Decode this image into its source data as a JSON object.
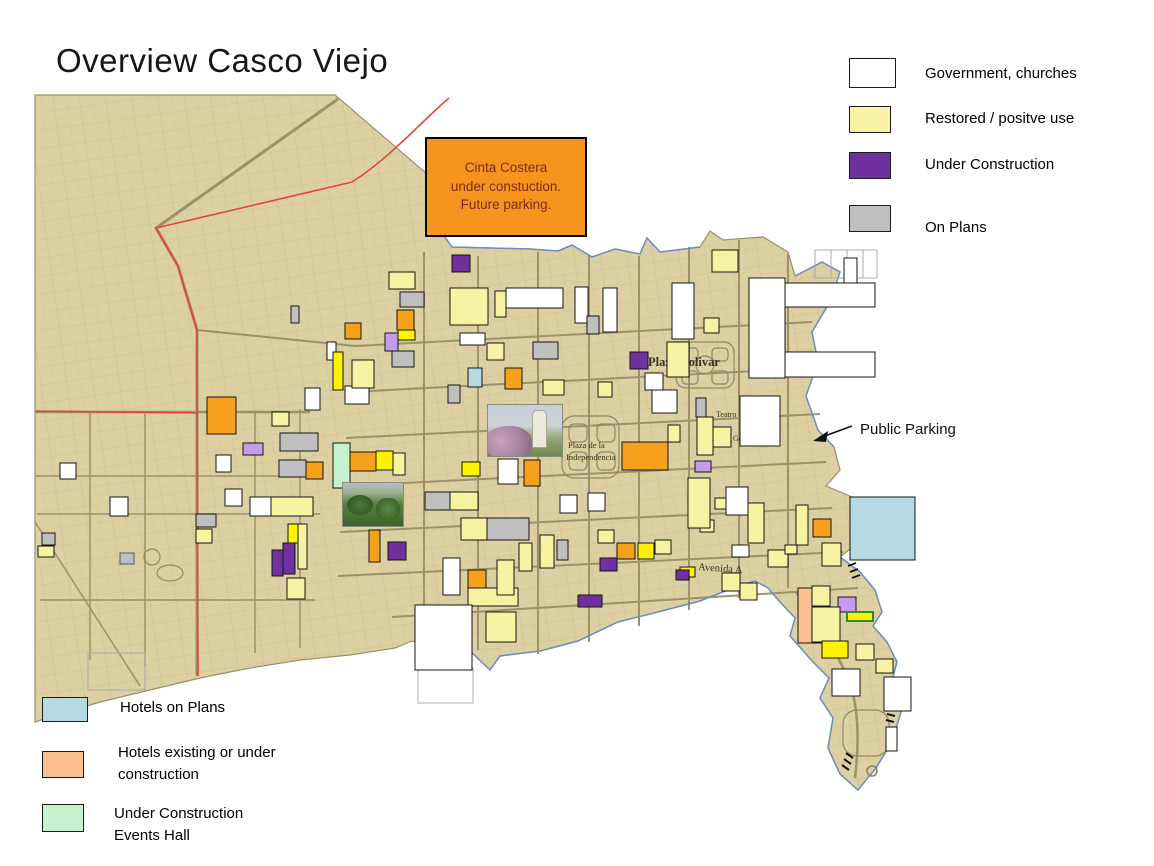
{
  "title": "Overview Casco Viejo",
  "callout": {
    "lines": [
      "Cinta Costera",
      "under constuction.",
      "Future parking."
    ],
    "fill": "#F7941E",
    "text_color": "#7B2A1E"
  },
  "legend_categories": {
    "items": [
      {
        "label": "Government, churches",
        "color": "#FFFFFF"
      },
      {
        "label": "Restored / positve use",
        "color": "#F7F3A2"
      },
      {
        "label": "Under Construction",
        "color": "#7030A0"
      },
      {
        "label": "On Plans",
        "color": "#BFBFBF"
      }
    ]
  },
  "legend_hotels": {
    "items": [
      {
        "label": "Hotels on Plans",
        "color": "#B5DAE3",
        "lines": [
          "Hotels on Plans",
          ""
        ]
      },
      {
        "label": "Hotels existing or under construction",
        "color": "#FAC091",
        "lines": [
          "Hotels existing or under",
          "construction"
        ]
      },
      {
        "label": "Under Construction Events Hall",
        "color": "#C6F2CF",
        "lines": [
          "Under Construction",
          "Events Hall"
        ]
      }
    ]
  },
  "annotations": {
    "public_parking": "Public Parking"
  },
  "map": {
    "land_color": "#DDD1A3",
    "land_edge_color": "#97906B",
    "street_color": "#9C9168",
    "route_color": "#E2443B",
    "coast_color": "#6C8EBF",
    "label_color": "#3A3222",
    "palette": {
      "W": "#FFFFFF",
      "Y": "#F7F3A2",
      "BY": "#FFF200",
      "O": "#F5A11B",
      "P": "#7030A0",
      "LP": "#C79BEB",
      "G": "#BFBFBF",
      "LB": "#B5DAE3",
      "MG": "#C6F2CF",
      "PC": "#FAC091"
    },
    "labels": [
      {
        "text": "Plaza Bolivar",
        "x": 648,
        "y": 366,
        "size": 12.5,
        "weight": "bold",
        "rotate": 0
      },
      {
        "text": "Teatro",
        "x": 716,
        "y": 417,
        "size": 8,
        "weight": "normal",
        "rotate": 0
      },
      {
        "text": "Gobierno",
        "x": 733,
        "y": 441,
        "size": 8,
        "weight": "normal",
        "rotate": 0
      },
      {
        "text": "Plaza de la",
        "x": 568,
        "y": 448,
        "size": 8.5,
        "weight": "normal",
        "rotate": 0
      },
      {
        "text": "Independencia",
        "x": 566,
        "y": 460,
        "size": 8.5,
        "weight": "normal",
        "rotate": 0
      },
      {
        "text": "Avenida A",
        "x": 698,
        "y": 570,
        "size": 10.5,
        "weight": "normal",
        "rotate": 4
      }
    ],
    "buildings": [
      [
        452,
        255,
        18,
        17,
        "P"
      ],
      [
        389,
        272,
        26,
        17,
        "Y"
      ],
      [
        400,
        292,
        24,
        15,
        "G"
      ],
      [
        397,
        310,
        17,
        20,
        "O"
      ],
      [
        398,
        330,
        17,
        10,
        "BY"
      ],
      [
        385,
        333,
        13,
        18,
        "LP"
      ],
      [
        392,
        351,
        22,
        16,
        "G"
      ],
      [
        450,
        288,
        38,
        37,
        "Y"
      ],
      [
        495,
        291,
        11,
        26,
        "Y"
      ],
      [
        506,
        288,
        57,
        20,
        "W"
      ],
      [
        575,
        287,
        13,
        36,
        "W"
      ],
      [
        587,
        316,
        12,
        18,
        "G"
      ],
      [
        603,
        288,
        14,
        44,
        "W"
      ],
      [
        672,
        283,
        22,
        56,
        "W"
      ],
      [
        712,
        250,
        26,
        22,
        "Y"
      ],
      [
        704,
        318,
        15,
        15,
        "Y"
      ],
      [
        749,
        278,
        36,
        100,
        "W"
      ],
      [
        785,
        283,
        90,
        24,
        "W"
      ],
      [
        785,
        352,
        90,
        25,
        "W"
      ],
      [
        844,
        258,
        13,
        25,
        "W"
      ],
      [
        460,
        333,
        25,
        12,
        "W"
      ],
      [
        487,
        343,
        17,
        17,
        "Y"
      ],
      [
        533,
        342,
        25,
        17,
        "G"
      ],
      [
        468,
        368,
        14,
        19,
        "LB"
      ],
      [
        505,
        368,
        17,
        21,
        "O"
      ],
      [
        448,
        385,
        12,
        18,
        "G"
      ],
      [
        543,
        380,
        21,
        15,
        "Y"
      ],
      [
        598,
        382,
        14,
        15,
        "Y"
      ],
      [
        645,
        373,
        18,
        17,
        "W"
      ],
      [
        667,
        342,
        22,
        35,
        "Y"
      ],
      [
        630,
        352,
        18,
        17,
        "P"
      ],
      [
        652,
        390,
        25,
        23,
        "W"
      ],
      [
        740,
        396,
        40,
        50,
        "W"
      ],
      [
        696,
        398,
        10,
        19,
        "G"
      ],
      [
        697,
        417,
        16,
        38,
        "Y"
      ],
      [
        713,
        427,
        18,
        20,
        "Y"
      ],
      [
        622,
        442,
        46,
        28,
        "O"
      ],
      [
        668,
        425,
        12,
        17,
        "Y"
      ],
      [
        695,
        461,
        16,
        11,
        "LP"
      ],
      [
        560,
        495,
        17,
        18,
        "W"
      ],
      [
        588,
        493,
        17,
        18,
        "W"
      ],
      [
        498,
        459,
        20,
        25,
        "W"
      ],
      [
        524,
        460,
        16,
        26,
        "O"
      ],
      [
        207,
        397,
        29,
        37,
        "O"
      ],
      [
        272,
        412,
        17,
        14,
        "Y"
      ],
      [
        305,
        388,
        15,
        22,
        "W"
      ],
      [
        345,
        386,
        24,
        18,
        "W"
      ],
      [
        352,
        360,
        22,
        28,
        "Y"
      ],
      [
        345,
        323,
        16,
        16,
        "O"
      ],
      [
        291,
        306,
        8,
        17,
        "G"
      ],
      [
        327,
        342,
        9,
        18,
        "W"
      ],
      [
        333,
        352,
        10,
        38,
        "BY"
      ],
      [
        243,
        443,
        20,
        12,
        "LP"
      ],
      [
        280,
        433,
        38,
        18,
        "G"
      ],
      [
        279,
        460,
        27,
        17,
        "G"
      ],
      [
        306,
        462,
        17,
        17,
        "O"
      ],
      [
        333,
        443,
        17,
        45,
        "MG"
      ],
      [
        350,
        452,
        26,
        19,
        "O"
      ],
      [
        376,
        451,
        17,
        19,
        "BY"
      ],
      [
        393,
        453,
        12,
        22,
        "Y"
      ],
      [
        216,
        455,
        15,
        17,
        "W"
      ],
      [
        60,
        463,
        16,
        16,
        "W"
      ],
      [
        110,
        497,
        18,
        19,
        "W"
      ],
      [
        225,
        489,
        17,
        17,
        "W"
      ],
      [
        250,
        497,
        21,
        19,
        "W"
      ],
      [
        271,
        497,
        42,
        19,
        "Y"
      ],
      [
        196,
        514,
        20,
        13,
        "G"
      ],
      [
        196,
        529,
        16,
        14,
        "Y"
      ],
      [
        42,
        533,
        13,
        12,
        "G"
      ],
      [
        38,
        546,
        16,
        11,
        "Y"
      ],
      [
        272,
        550,
        11,
        26,
        "P"
      ],
      [
        283,
        543,
        12,
        31,
        "P"
      ],
      [
        287,
        578,
        18,
        21,
        "Y"
      ],
      [
        288,
        524,
        10,
        19,
        "BY"
      ],
      [
        298,
        524,
        9,
        45,
        "Y"
      ],
      [
        369,
        530,
        11,
        32,
        "O"
      ],
      [
        388,
        542,
        18,
        18,
        "P"
      ],
      [
        425,
        492,
        25,
        18,
        "G"
      ],
      [
        450,
        492,
        28,
        18,
        "Y"
      ],
      [
        462,
        462,
        18,
        14,
        "BY"
      ],
      [
        487,
        518,
        42,
        22,
        "G"
      ],
      [
        461,
        518,
        26,
        22,
        "Y"
      ],
      [
        443,
        558,
        17,
        37,
        "W"
      ],
      [
        468,
        570,
        18,
        18,
        "O"
      ],
      [
        468,
        588,
        50,
        18,
        "Y"
      ],
      [
        497,
        560,
        17,
        35,
        "Y"
      ],
      [
        415,
        605,
        57,
        65,
        "W"
      ],
      [
        486,
        612,
        30,
        30,
        "Y"
      ],
      [
        540,
        535,
        14,
        33,
        "Y"
      ],
      [
        519,
        543,
        13,
        28,
        "Y"
      ],
      [
        557,
        540,
        11,
        20,
        "G"
      ],
      [
        598,
        530,
        16,
        13,
        "Y"
      ],
      [
        600,
        558,
        17,
        13,
        "P"
      ],
      [
        578,
        595,
        24,
        12,
        "P"
      ],
      [
        617,
        543,
        18,
        16,
        "O"
      ],
      [
        638,
        543,
        16,
        16,
        "BY"
      ],
      [
        655,
        540,
        16,
        14,
        "Y"
      ],
      [
        680,
        567,
        15,
        10,
        "BY"
      ],
      [
        722,
        573,
        18,
        18,
        "Y"
      ],
      [
        740,
        583,
        17,
        17,
        "Y"
      ],
      [
        732,
        545,
        17,
        12,
        "W"
      ],
      [
        768,
        550,
        20,
        17,
        "Y"
      ],
      [
        785,
        545,
        12,
        9,
        "Y"
      ],
      [
        700,
        520,
        14,
        12,
        "Y"
      ],
      [
        715,
        498,
        13,
        11,
        "Y"
      ],
      [
        726,
        487,
        22,
        28,
        "W"
      ],
      [
        748,
        503,
        16,
        40,
        "Y"
      ],
      [
        688,
        478,
        22,
        50,
        "Y"
      ],
      [
        676,
        570,
        13,
        10,
        "P"
      ],
      [
        796,
        505,
        12,
        40,
        "Y"
      ],
      [
        813,
        519,
        18,
        18,
        "O"
      ],
      [
        822,
        543,
        19,
        23,
        "Y"
      ],
      [
        850,
        497,
        65,
        63,
        "LB"
      ],
      [
        798,
        588,
        32,
        55,
        "PC"
      ],
      [
        812,
        586,
        18,
        20,
        "Y"
      ],
      [
        838,
        597,
        18,
        15,
        "LP"
      ],
      [
        847,
        612,
        26,
        9,
        "BY",
        "#2E8B2E"
      ],
      [
        812,
        607,
        28,
        35,
        "Y"
      ],
      [
        822,
        641,
        26,
        17,
        "BY"
      ],
      [
        856,
        644,
        18,
        16,
        "Y"
      ],
      [
        876,
        659,
        17,
        14,
        "Y"
      ],
      [
        832,
        669,
        28,
        27,
        "W"
      ],
      [
        884,
        677,
        27,
        34,
        "W"
      ],
      [
        886,
        727,
        11,
        24,
        "W"
      ]
    ]
  }
}
